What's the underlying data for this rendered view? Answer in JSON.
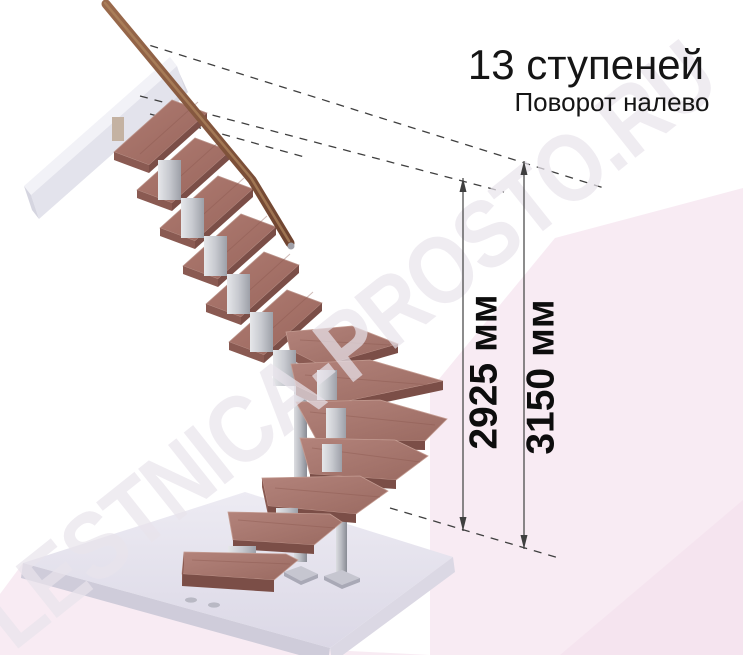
{
  "header": {
    "title": "13 ступеней",
    "subtitle": "Поворот налево"
  },
  "dimensions": {
    "inner": {
      "label": "2925 мм"
    },
    "outer": {
      "label": "3150 мм"
    }
  },
  "watermark": {
    "text": "LESTNICA-PROSTO.RU"
  },
  "staircase": {
    "steps_count": 13,
    "turn_direction": "налево",
    "rect_flight_steps": 6,
    "winder_steps": 4,
    "bottom_steps": 3
  },
  "colors": {
    "wood_top": "#a06f66",
    "wood_front": "#7b4e47",
    "wood_side": "#8a5a52",
    "handrail": "#8a5a40",
    "metal": "#9aa0a8",
    "slab_top": "#e6e3ed",
    "slab_edge": "#cfccda",
    "wall_beam": "#e3e3ec",
    "pink_band": "#f8ebf3",
    "dimension_line": "#3f3f3f",
    "text": "#111111",
    "background": "#ffffff"
  }
}
